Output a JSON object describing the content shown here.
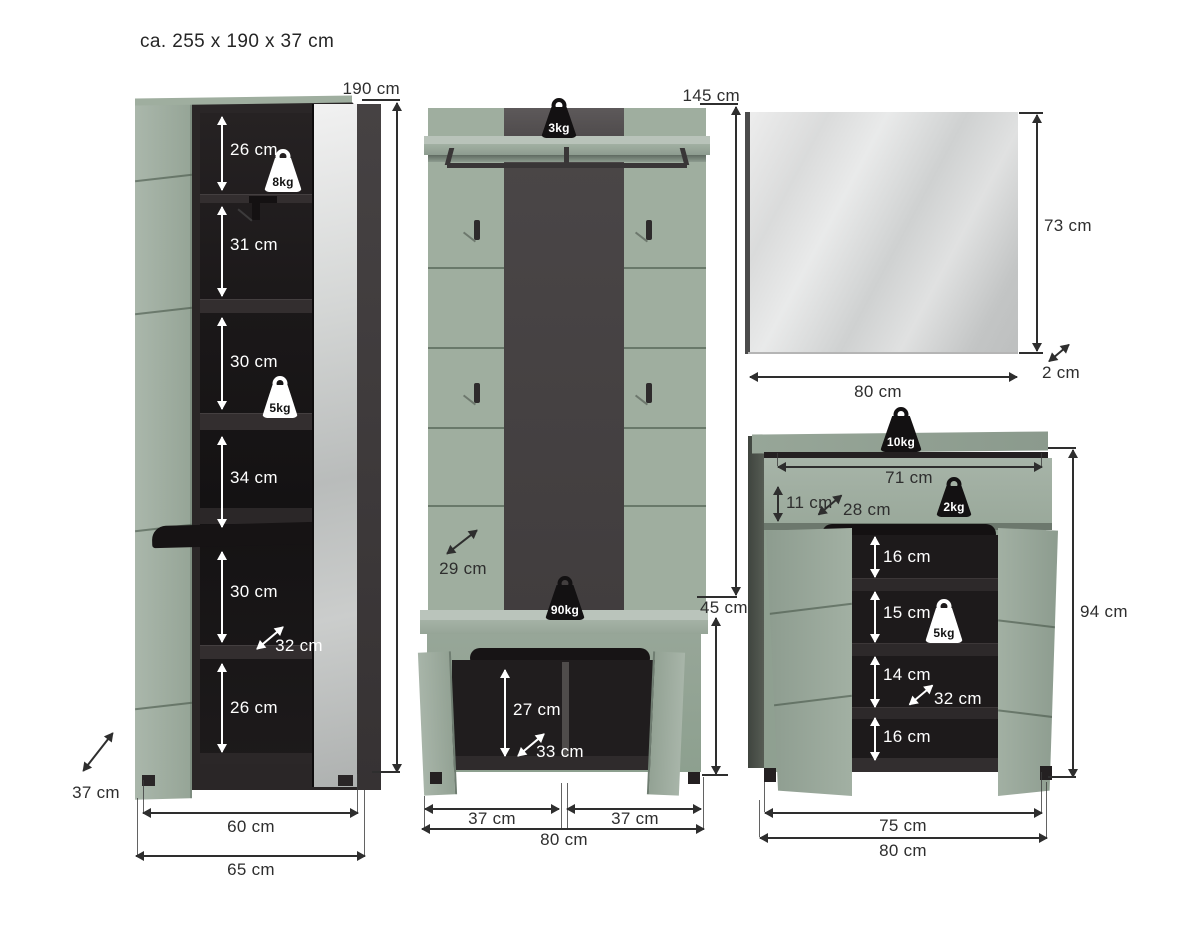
{
  "title": "ca. 255 x 190 x 37 cm",
  "units": {
    "wardrobe": {
      "height": "190 cm",
      "shelf_sections": [
        "26 cm",
        "31 cm",
        "30 cm",
        "34 cm",
        "30 cm",
        "26 cm"
      ],
      "max_load_top": "8kg",
      "max_load_shelf": "5kg",
      "inner_depth": "32 cm",
      "depth": "37 cm",
      "inner_width": "60 cm",
      "width": "65 cm"
    },
    "coat_rack": {
      "height": "145 cm",
      "max_load_shelf": "3kg",
      "max_load_bench": "90kg",
      "panel_depth": "29 cm",
      "bench_height": "45 cm",
      "bench_inner_height": "27 cm",
      "bench_depth": "33 cm",
      "door_width_left": "37 cm",
      "door_width_right": "37 cm",
      "width": "80 cm"
    },
    "mirror": {
      "height": "73 cm",
      "width": "80 cm",
      "depth": "2 cm"
    },
    "shoe_cabinet": {
      "max_load_top": "10kg",
      "drawer_width": "71 cm",
      "drawer_height": "11 cm",
      "drawer_depth": "28 cm",
      "max_load_drawer": "2kg",
      "max_load_shelf": "5kg",
      "shelf_sections": [
        "16 cm",
        "15 cm",
        "14 cm",
        "16 cm"
      ],
      "shelf_depth": "32 cm",
      "height": "94 cm",
      "inner_width": "75 cm",
      "width": "80 cm"
    }
  },
  "colors": {
    "furniture_green": "#9dab9e",
    "interior_dark": "#1f1c1d",
    "accent_stripe": "#464243",
    "mirror_silver": "#d6d8d8",
    "dimension_text": "#2e2e2e"
  }
}
